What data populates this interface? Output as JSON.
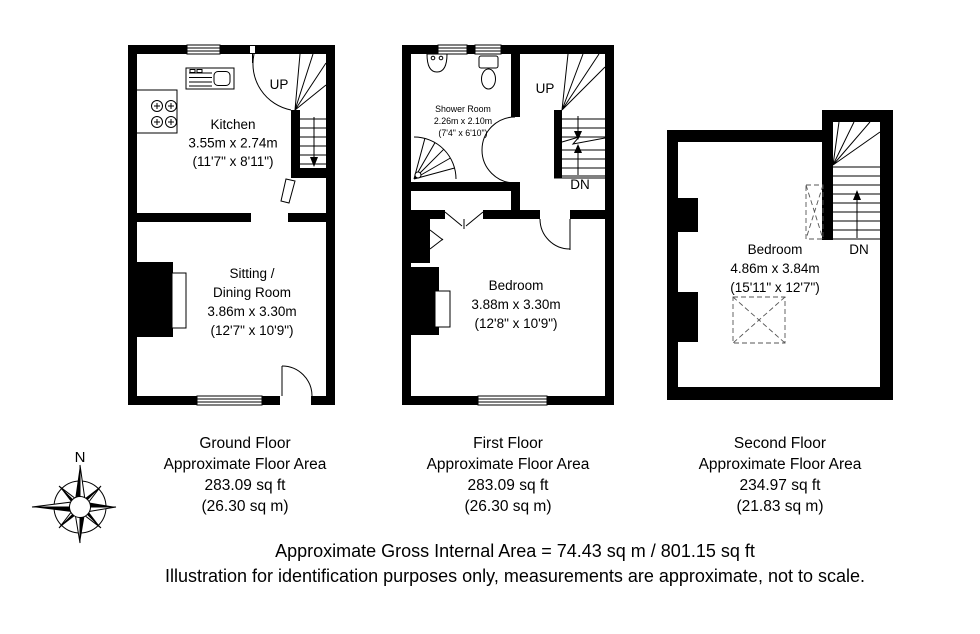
{
  "colors": {
    "ink": "#000000",
    "background": "#ffffff"
  },
  "floors": [
    {
      "label": {
        "title": "Ground Floor",
        "subtitle": "Approximate Floor Area",
        "area_imperial": "283.09 sq ft",
        "area_metric": "(26.30 sq m)"
      },
      "rooms": [
        {
          "name": "Kitchen",
          "dims_metric": "3.55m x 2.74m",
          "dims_imperial": "(11'7\" x 8'11\")"
        },
        {
          "name_line1": "Sitting /",
          "name_line2": "Dining Room",
          "dims_metric": "3.86m x 3.30m",
          "dims_imperial": "(12'7\" x 10'9\")"
        }
      ],
      "stairs": {
        "up": "UP"
      }
    },
    {
      "label": {
        "title": "First Floor",
        "subtitle": "Approximate Floor Area",
        "area_imperial": "283.09 sq ft",
        "area_metric": "(26.30 sq m)"
      },
      "rooms": [
        {
          "name": "Shower Room",
          "dims_metric": "2.26m x 2.10m",
          "dims_imperial": "(7'4\" x 6'10\")"
        },
        {
          "name": "Bedroom",
          "dims_metric": "3.88m x 3.30m",
          "dims_imperial": "(12'8\" x 10'9\")"
        }
      ],
      "stairs": {
        "up": "UP",
        "down": "DN"
      }
    },
    {
      "label": {
        "title": "Second Floor",
        "subtitle": "Approximate Floor Area",
        "area_imperial": "234.97 sq ft",
        "area_metric": "(21.83 sq m)"
      },
      "rooms": [
        {
          "name": "Bedroom",
          "dims_metric": "4.86m x 3.84m",
          "dims_imperial": "(15'11\" x 12'7\")"
        }
      ],
      "stairs": {
        "down": "DN"
      }
    }
  ],
  "compass": {
    "label": "N"
  },
  "footer": {
    "line1": "Approximate Gross Internal Area = 74.43 sq m / 801.15 sq ft",
    "line2": "Illustration for identification purposes only, measurements are approximate, not to scale."
  }
}
